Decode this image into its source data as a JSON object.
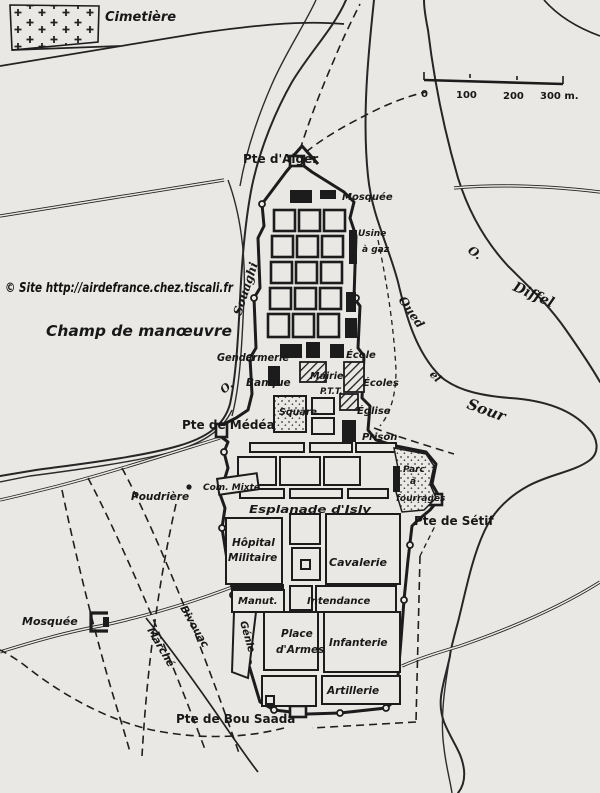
{
  "map": {
    "watermark": "© Site http://airdefrance.chez.tiscali.fr",
    "colors": {
      "paper": "#e9e8e4",
      "ink": "#1c1c1c",
      "watermark_ink": "#111111"
    },
    "scale_bar": {
      "t0": "0",
      "t100": "100",
      "t200": "200",
      "t300": "300 m."
    },
    "areas": {
      "cimetiere": "Cimetière",
      "champ_de_manoeuvre": "Champ de manœuvre",
      "esplanade_disly": "Esplanade d'Isly",
      "bivouac": "Bivouac",
      "marche": "Marché"
    },
    "gates": {
      "alger": "Pte d'Alger",
      "medea": "Pte de Médéa",
      "setif": "Pte de Sétif",
      "bou_saada": "Pte de Bou Saada"
    },
    "buildings": {
      "mosquee_nord": "Mosquée",
      "usine_l1": "Usine",
      "usine_l2": "à gaz",
      "gendarmerie": "Gendarmerie",
      "ecole": "École",
      "banque": "Banque",
      "mairie": "Mairie",
      "ptt": "P.T.T.",
      "ecoles": "Écoles",
      "square": "Square",
      "eglise": "Église",
      "prison": "Prison",
      "poudriere": "Poudrière",
      "com_mixte": "Com. Mixte",
      "parc_l1": "Parc",
      "parc_l2": "à",
      "parc_l3": "fourrages",
      "hopital_l1": "Hôpital",
      "hopital_l2": "Militaire",
      "cavalerie": "Cavalerie",
      "manutention": "Manut.",
      "intendance": "Intendance",
      "genie": "Génie",
      "place_armes_l1": "Place",
      "place_armes_l2": "d'Armes",
      "infanterie": "Infanterie",
      "artillerie": "Artillerie",
      "mosquee_ouest": "Mosquée"
    },
    "rivers": {
      "o_souaghi_abbr": "O.",
      "souaghi": "Souaghi",
      "oued": "Oued",
      "el": "el",
      "sour": "Sour",
      "o_diffel_abbr": "O.",
      "diffel": "Diffel"
    }
  }
}
